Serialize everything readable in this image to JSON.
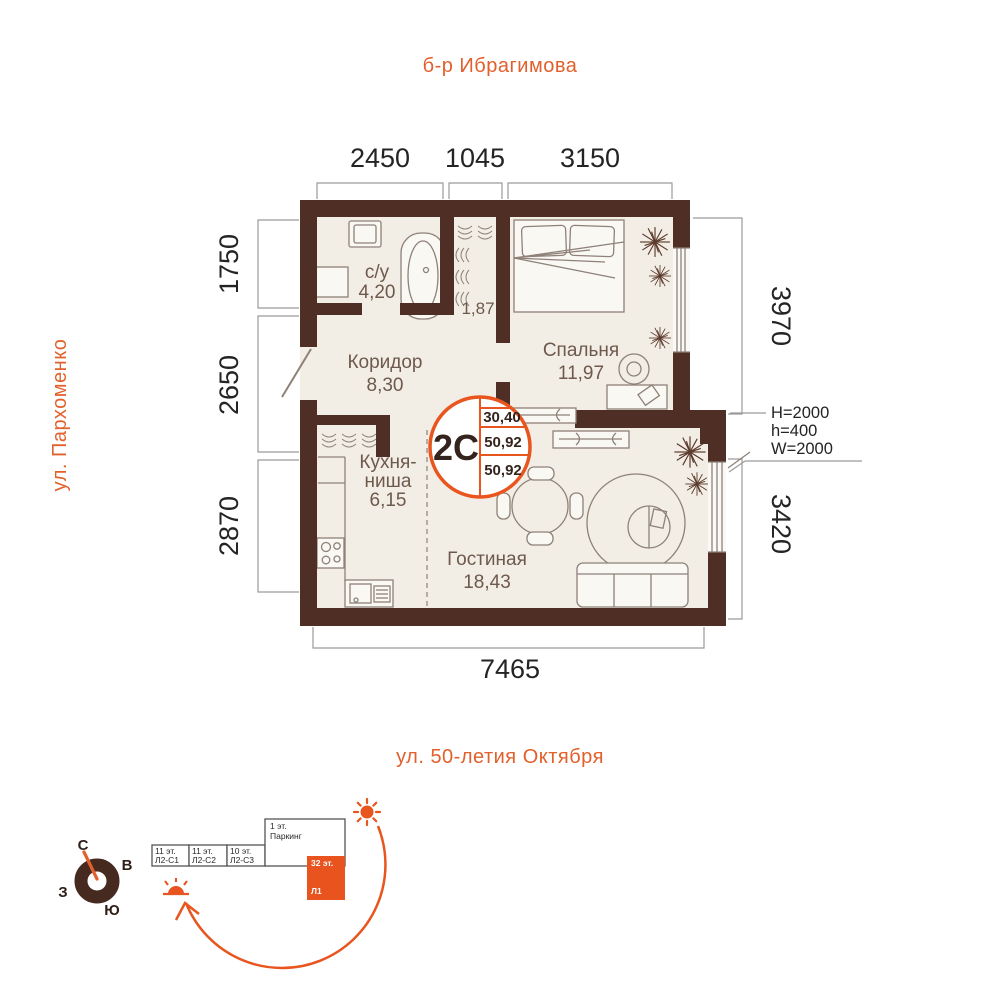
{
  "streets": {
    "top": "б-р Ибрагимова",
    "left": "ул. Пархоменко",
    "bottom": "ул. 50-летия Октября"
  },
  "dimensions": {
    "top": [
      "2450",
      "1045",
      "3150"
    ],
    "left": [
      "1750",
      "2650",
      "2870"
    ],
    "right": [
      "3970",
      "3420"
    ],
    "bottom": "7465"
  },
  "window_specs": [
    "H=2000",
    "h=400",
    "W=2000"
  ],
  "rooms": {
    "bathroom": {
      "name": "с/у",
      "area": "4,20"
    },
    "corridor": {
      "name": "Коридор",
      "area": "8,30"
    },
    "bedroom": {
      "name": "Спальня",
      "area": "11,97"
    },
    "wardrobe": {
      "area": "1,87"
    },
    "kitchen": {
      "name_line1": "Кухня-",
      "name_line2": "ниша",
      "area": "6,15"
    },
    "living": {
      "name": "Гостиная",
      "area": "18,43"
    }
  },
  "badge": {
    "type": "2С",
    "values": [
      "30,40",
      "50,92",
      "50,92"
    ]
  },
  "compass": {
    "north": "С",
    "east": "В",
    "west": "З",
    "south": "Ю"
  },
  "site_plan": {
    "blocks": [
      {
        "floors": "11 эт.",
        "name": "Л2-С1"
      },
      {
        "floors": "11 эт.",
        "name": "Л2-С2"
      },
      {
        "floors": "10 эт.",
        "name": "Л2-С3"
      },
      {
        "floors": "1 эт.",
        "name": "Паркинг"
      },
      {
        "floors": "32 эт.",
        "name": "Л1"
      }
    ]
  },
  "colors": {
    "accent": "#E8551F",
    "wall": "#4E2E25",
    "floor": "#F2EEE6"
  }
}
